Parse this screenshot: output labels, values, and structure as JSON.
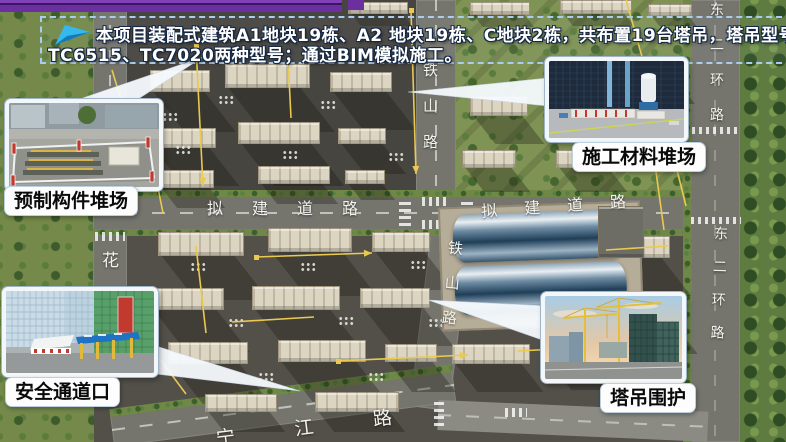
{
  "header": {
    "line1": "本项目装配式建筑A1地块19栋、A2 地块19栋、C地块2栋，共布置19台塔吊，塔吊型号主要使用",
    "line2": "TC6515、TC7020两种型号；通过BIM模拟施工。",
    "icon": "paper-plane-arrow",
    "accent_color": "#35b9ec",
    "bar_color": "#6b2fa0"
  },
  "callouts": [
    {
      "id": "precast-yard",
      "label": "预制构件堆场"
    },
    {
      "id": "material-yard",
      "label": "施工材料堆场"
    },
    {
      "id": "safety-passage",
      "label": "安全通道口"
    },
    {
      "id": "tower-crane-enclosure",
      "label": "塔吊围护"
    }
  ],
  "roads": {
    "tieshan_upper": "铁山路",
    "tieshan_lower": "铁山路",
    "planned_left": "拟建道路",
    "planned_right": "拟建道路",
    "donger_upper": "东二环路",
    "donger_lower": "东二环路",
    "hua": "花",
    "ningjiang": "宁江路"
  },
  "colors": {
    "crane_line": "#e9c94f",
    "building": "#dcd5c2",
    "lawn": "#7f9355"
  }
}
